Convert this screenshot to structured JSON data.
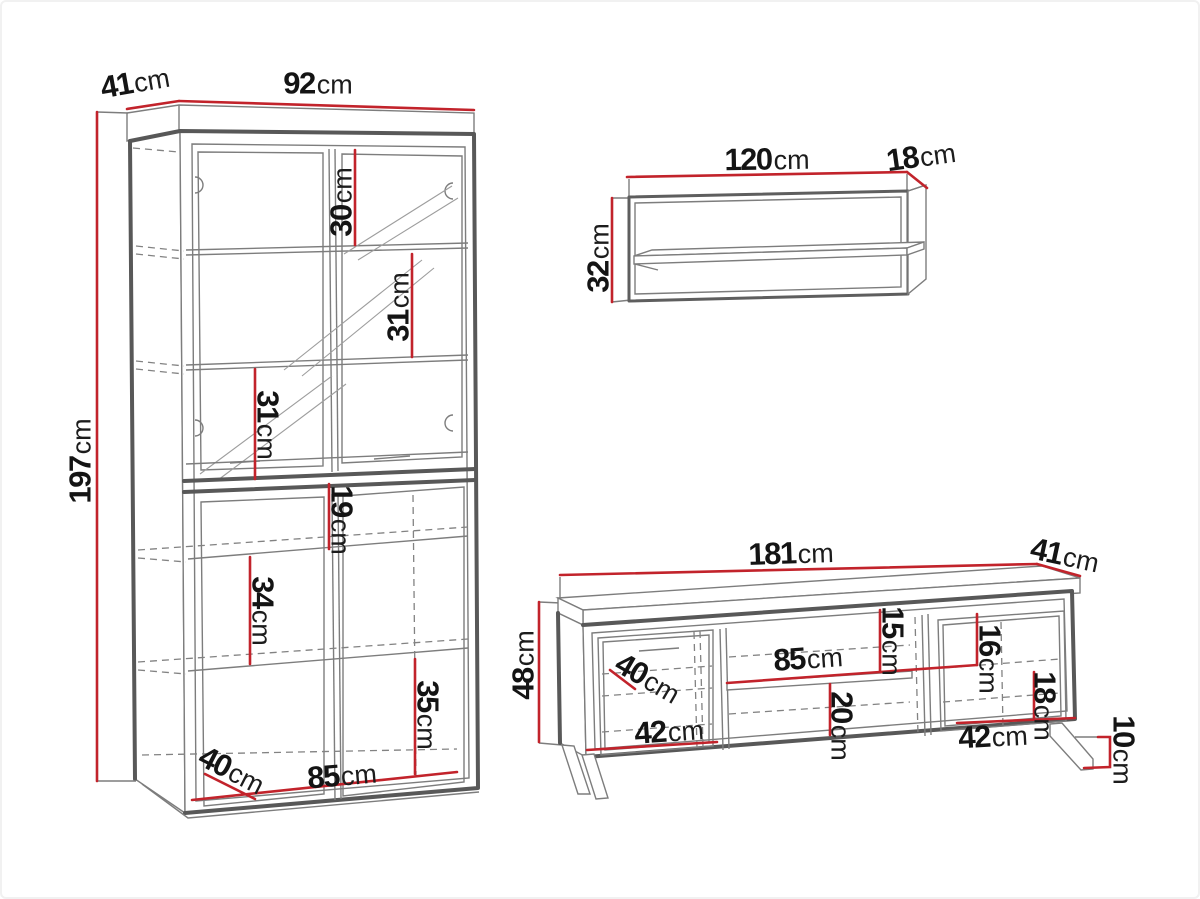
{
  "page": {
    "title": "Furniture set dimensions diagram",
    "accent_red": "#c2232b",
    "line_gray": "#5e5e5e",
    "background": "#ffffff"
  },
  "pieces": {
    "cabinet": {
      "name": "display-cabinet",
      "dims": {
        "depth": {
          "value": "41",
          "unit": "cm"
        },
        "width": {
          "value": "92",
          "unit": "cm"
        },
        "height": {
          "value": "197",
          "unit": "cm"
        },
        "spacing_top": {
          "value": "30",
          "unit": "cm"
        },
        "spacing_upper": {
          "value": "31",
          "unit": "cm"
        },
        "spacing_middle": {
          "value": "31",
          "unit": "cm"
        },
        "spacing_behind": {
          "value": "19",
          "unit": "cm"
        },
        "spacing_lower": {
          "value": "34",
          "unit": "cm"
        },
        "spacing_bottom": {
          "value": "35",
          "unit": "cm"
        },
        "interior_depth": {
          "value": "40",
          "unit": "cm"
        },
        "interior_width": {
          "value": "85",
          "unit": "cm"
        }
      }
    },
    "wall_shelf": {
      "name": "wall-shelf",
      "dims": {
        "width": {
          "value": "120",
          "unit": "cm"
        },
        "depth": {
          "value": "18",
          "unit": "cm"
        },
        "height": {
          "value": "32",
          "unit": "cm"
        }
      }
    },
    "tv_stand": {
      "name": "tv-stand",
      "dims": {
        "width": {
          "value": "181",
          "unit": "cm"
        },
        "depth": {
          "value": "41",
          "unit": "cm"
        },
        "height": {
          "value": "48",
          "unit": "cm"
        },
        "interior_depth": {
          "value": "40",
          "unit": "cm"
        },
        "left_compartment_width": {
          "value": "42",
          "unit": "cm"
        },
        "shelf_width": {
          "value": "85",
          "unit": "cm"
        },
        "shelf_top_gap": {
          "value": "15",
          "unit": "cm"
        },
        "shelf_bottom_gap": {
          "value": "20",
          "unit": "cm"
        },
        "right_top_gap": {
          "value": "16",
          "unit": "cm"
        },
        "right_bottom_gap": {
          "value": "18",
          "unit": "cm"
        },
        "right_compartment_width": {
          "value": "42",
          "unit": "cm"
        },
        "leg_height": {
          "value": "10",
          "unit": "cm"
        }
      }
    }
  }
}
